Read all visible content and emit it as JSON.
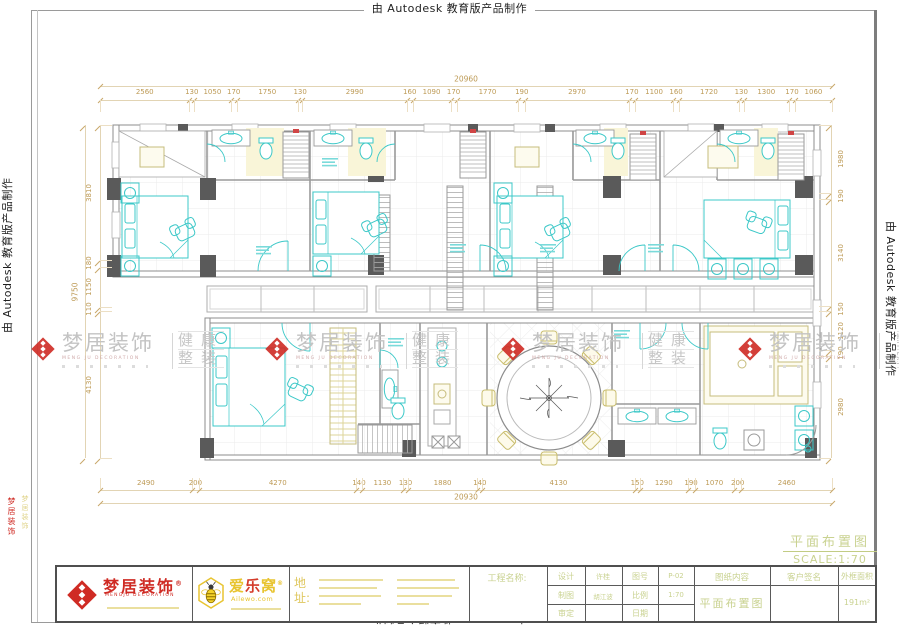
{
  "autodesk_notice": "由 Autodesk 教育版产品制作",
  "watermark": {
    "brand": "梦居装饰",
    "sub": "MENG JU DECORATION",
    "tag1": "健康",
    "tag2": "整装"
  },
  "side_text": {
    "red": "梦居装饰",
    "gold": "梦居装饰"
  },
  "dimensions": {
    "top": {
      "values": [
        2560,
        130,
        1050,
        170,
        1750,
        130,
        2990,
        160,
        1090,
        170,
        1770,
        190,
        2970,
        170,
        1100,
        160,
        1720,
        130,
        1300,
        170,
        1060
      ],
      "total": "20960"
    },
    "bottom": {
      "values": [
        2490,
        200,
        4270,
        140,
        1130,
        130,
        1880,
        140,
        4130,
        150,
        1290,
        190,
        1070,
        200,
        2460
      ],
      "total": "20930"
    },
    "left": {
      "values": [
        3810,
        180,
        1150,
        110,
        4130
      ],
      "total": "9750"
    },
    "right": {
      "values": [
        1980,
        190,
        3140,
        150,
        1120,
        190,
        2980
      ]
    }
  },
  "drawing_title": {
    "name": "平面布置图",
    "scale": "SCALE:1:70"
  },
  "title_block": {
    "brand1": {
      "name": "梦居装饰",
      "reg": "®",
      "sub": "MENGJU DECORATION"
    },
    "brand2": {
      "n1": "爱",
      "n2": "乐",
      "n3": "窝",
      "reg": "®",
      "sub": "Ailewo.com"
    },
    "address_label": "地址:",
    "project_label": "工程名称:",
    "table": {
      "rows": [
        {
          "l1": "设计",
          "v1": "许桂",
          "l2": "图号",
          "v2": "P-02"
        },
        {
          "l1": "制图",
          "v1": "胡江波",
          "l2": "比例",
          "v2": "1:70"
        },
        {
          "l1": "审定",
          "v1": "",
          "l2": "日期",
          "v2": ""
        }
      ]
    },
    "content_label": "图纸内容",
    "content_value": "平面布置图",
    "sign_label": "客户签名",
    "area_label": "外框面积",
    "area_value": "191m²"
  }
}
